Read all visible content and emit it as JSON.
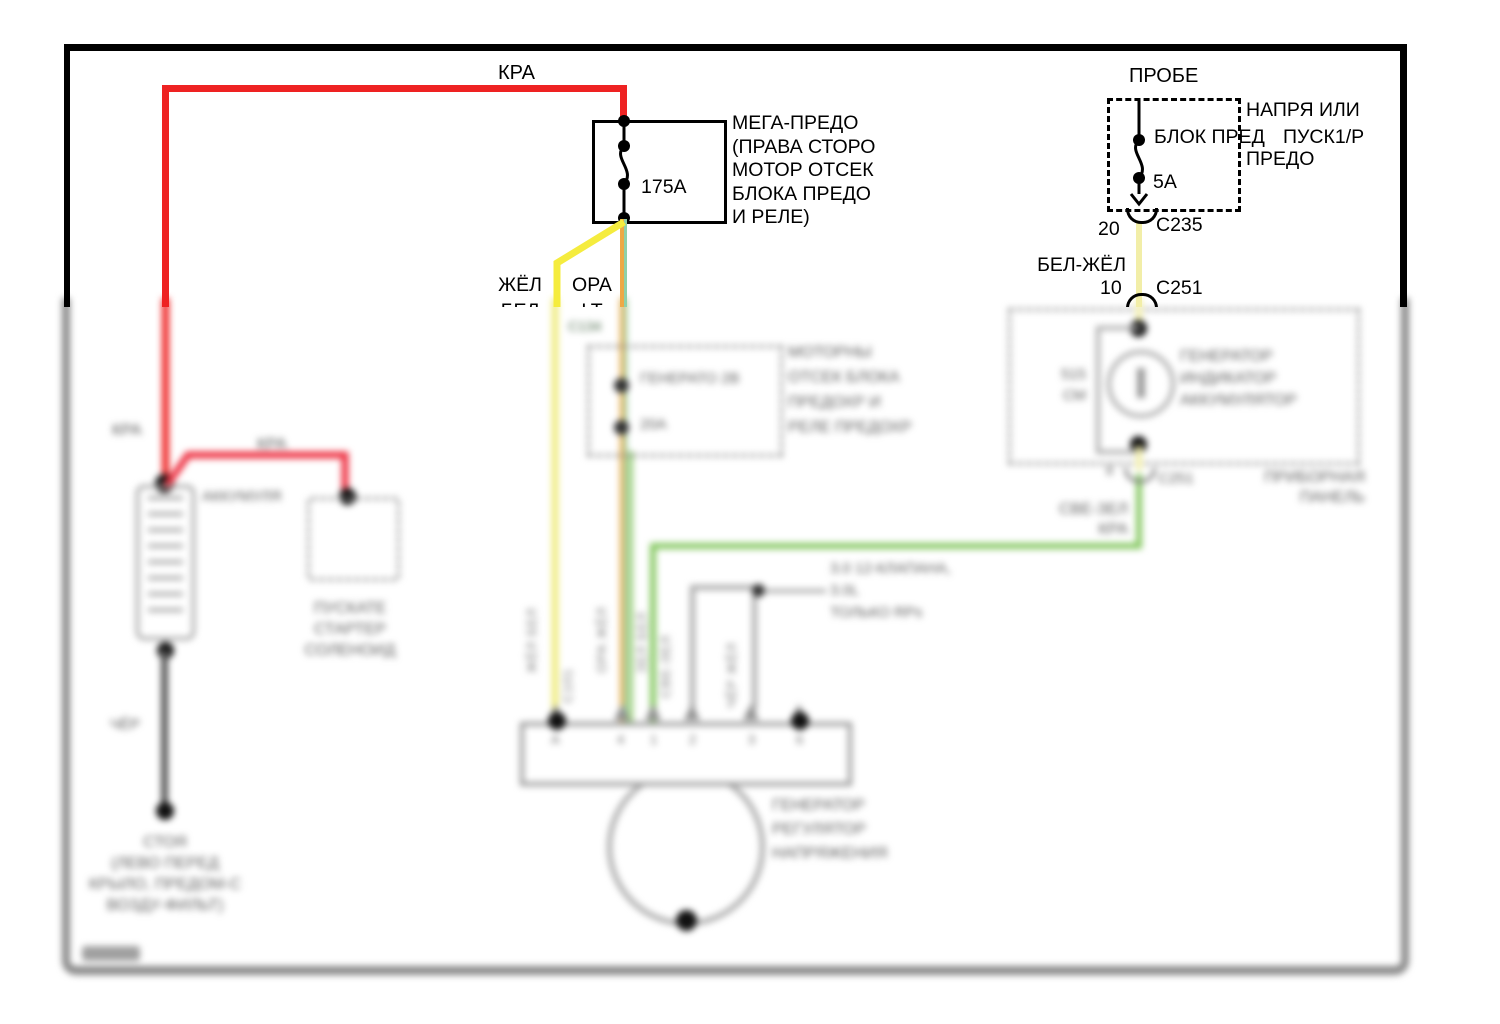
{
  "colors": {
    "wire_red": "#ee2222",
    "wire_yellow": "#f5ec3e",
    "wire_pale_yellow": "#f2eea8",
    "wire_orange": "#eda845",
    "wire_green": "#9dcf7c",
    "wire_teal": "#8fd0a8",
    "frame_black": "#000000",
    "frame_gray": "#8a8a8a",
    "blur_gray": "#9a9a9a"
  },
  "sharp": {
    "kra_top": "КРА",
    "mega_fuse": {
      "amp": "175A",
      "label": [
        "МЕГА-ПРЕДО",
        "(ПРАВА СТОРО",
        "МОТОР ОТСЕК",
        "БЛОКА ПРЕДО",
        "И РЕЛЕ)"
      ]
    },
    "wire_labels": {
      "zhel": "ЖЁЛ",
      "bel": "БЕЛ",
      "ora": "ОРА",
      "lt": "LT"
    },
    "probe_fuse": {
      "title": "ПРОБЕ",
      "block_label": "БЛОК ПРЕД",
      "side_text": [
        "НАПРЯ ИЛИ",
        "ПУСК1/Р",
        "ПРЕДО"
      ],
      "amp": "5А",
      "pin_20": "20",
      "conn_c235": "С235",
      "wire_bel_zhel": "БЕЛ-ЖЁЛ",
      "pin_10": "10",
      "conn_c251": "С251"
    }
  },
  "blurred": {
    "kra_left": "КРА",
    "kra_branch": "КРА",
    "battery_label": "АККУМУЛЯ",
    "solenoid_label": [
      "ПУСКАТЕ",
      "СТАРТЕР",
      "СОЛЕНОИД"
    ],
    "chyor": "ЧЁР",
    "ground_label": [
      "СТОЯ",
      "(ЛЕВО ПЕРЕД",
      "КРЫЛО, ПРЕДОМ-С",
      "ВОЗДУ-ФИЛЬТ)"
    ],
    "conn_c134": "С134",
    "fusebox_label": "ГЕНЕРАТО 2В",
    "fusebox_amp": "20А",
    "relay_box_label": [
      "МОТОРНЫ",
      "ОТСЕК БЛОКА",
      "ПРЕДОХР И",
      "РЕЛЕ ПРЕДОХР"
    ],
    "engine_note": [
      "3.0 12-КЛАПАНА,",
      "3.0L",
      "ТОЛЬКО RPs"
    ],
    "vertical_labels": [
      "ЖЁЛ БЕЛ",
      "С101",
      "ОРА ЖЁЛ",
      "ЗЕЛ БЕЛ",
      "СВЕ-ЗЕЛ",
      "ЧЁР ЖЁЛ"
    ],
    "pin_labels": [
      "A",
      "4",
      "1",
      "2",
      "3",
      "6"
    ],
    "generator_label": [
      "ГЕНЕРАТОР",
      "РЕГУЛЯТОР",
      "НАПРЯЖЕНИЯ"
    ],
    "indicator_left_label": [
      "515",
      "СМ"
    ],
    "indicator_right_label": [
      "ГЕНЕРАТОР",
      "ИНДИКАТОР",
      "АККУМУЛЯТОР"
    ],
    "pin_8": "8",
    "conn_indicator": "С251",
    "panel_label": [
      "ПРИБОРНАЯ",
      "ПАНЕЛЬ"
    ],
    "wire_sve_zel": [
      "СВЕ-ЗЕЛ",
      "КРА"
    ]
  }
}
